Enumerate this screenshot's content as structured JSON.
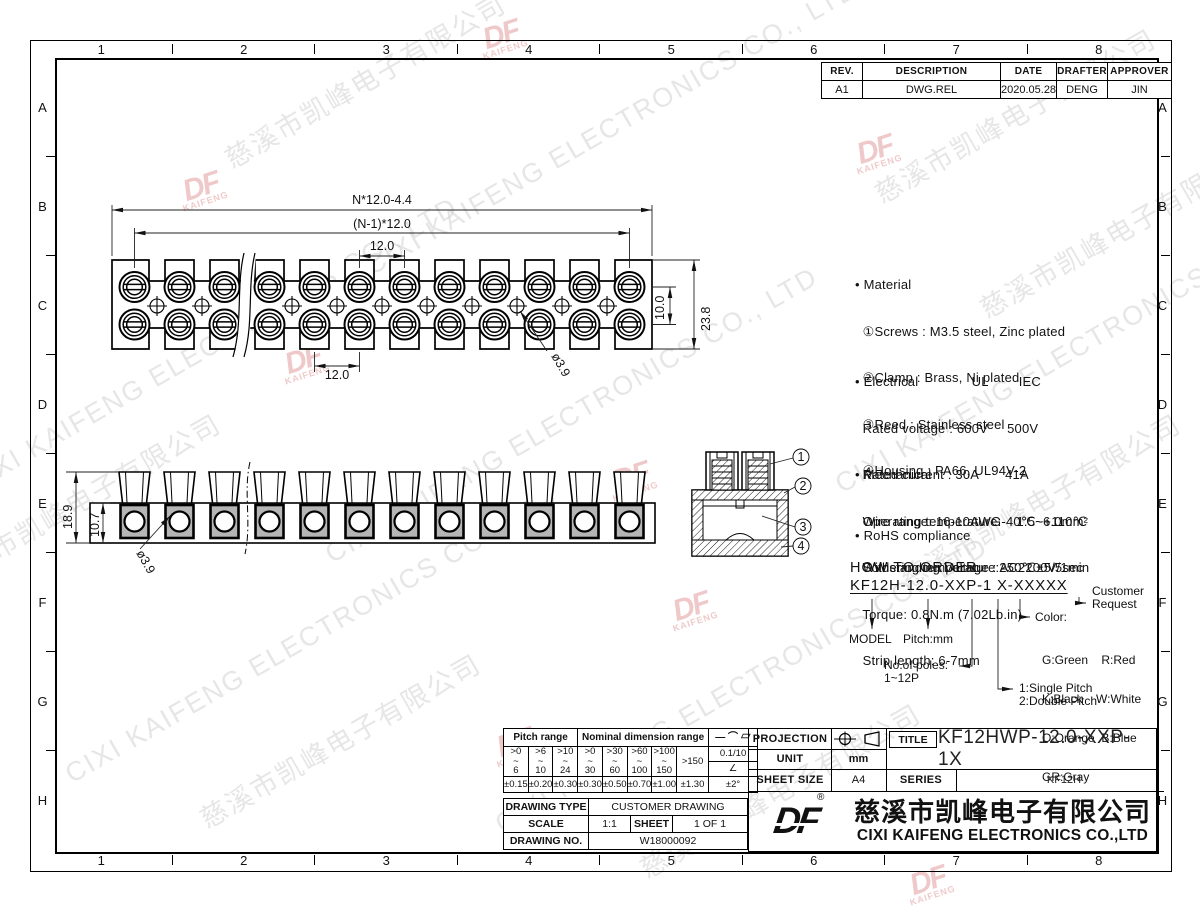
{
  "border": {
    "cols": [
      "1",
      "2",
      "3",
      "4",
      "5",
      "6",
      "7",
      "8"
    ],
    "rows": [
      "A",
      "B",
      "C",
      "D",
      "E",
      "F",
      "G",
      "H"
    ]
  },
  "rev_table": {
    "headers": [
      "REV.",
      "DESCRIPTION",
      "DATE",
      "DRAFTER",
      "APPROVER"
    ],
    "cells": [
      "A1",
      "DWG.REL",
      "2020.05.28",
      "DENG",
      "JIN"
    ]
  },
  "dims": {
    "n_total": "N*12.0-4.4",
    "n_pitch": "(N-1)*12.0",
    "pitch_top": "12.0",
    "pitch_bottom": "12.0",
    "hole_top": "ø3.9",
    "row_gap": "10.0",
    "width_total": "23.8",
    "height_total": "18.9",
    "height_body": "10.7",
    "hole_side": "ø3.9"
  },
  "callouts": [
    "1",
    "2",
    "3",
    "4"
  ],
  "specs": {
    "material": [
      "• Material",
      "  ①Screws : M3.5 steel, Zinc plated",
      "  ②Clamp : Brass, Ni plated",
      "  ③Reed : Stainless steel",
      "  ④Housing : PA66, UL94V-2"
    ],
    "electrical": [
      "• Electrical              UL        IEC",
      "  Rated voltage : 600V     500V",
      "  Rated current : 30A       41A",
      "  Wire range: 16-10AWG    1.5~6.0mm²",
      "  Withstanding Voltage : AC2200V/1min"
    ],
    "mechanical": [
      "• Mechanical",
      "  Operating temperature:-40℃~+110℃",
      "  Soldering temperature:250℃±5/5sec",
      "  Torque: 0.8N.m (7.02Lb.in)",
      "  Strip length: 6-7mm"
    ],
    "rohs": "• RoHS compliance"
  },
  "order": {
    "heading": "HOW TO ORDER",
    "code": "KF12H-12.0-XXP-1 X-XXXXX",
    "model": "MODEL",
    "pitch": "Pitch:mm",
    "poles_1": "No.of poles:",
    "poles_2": "1~12P",
    "color_label": "Color:",
    "colors": [
      "G:Green    R:Red",
      "K:Black    W:White",
      "O:Orange  B:Blue",
      "GR:Gray"
    ],
    "pitch_type_1": "1:Single Pitch",
    "pitch_type_2": "2:Double Pitch",
    "customer_1": "Customer",
    "customer_2": "Request"
  },
  "tol": {
    "pitch_header": "Pitch range",
    "nominal_header": "Nominal dimension range",
    "symbols": "— ⌒ ▱",
    "tilde": "~",
    "ranges": [
      [
        ">0",
        "6"
      ],
      [
        ">6",
        "10"
      ],
      [
        ">10",
        "24"
      ],
      [
        ">0",
        "30"
      ],
      [
        ">30",
        "60"
      ],
      [
        ">60",
        "100"
      ],
      [
        ">100",
        "150"
      ]
    ],
    "last_range": ">150",
    "flat_tol": "0.1/10",
    "angle_symbol": "∠",
    "tols": [
      "±0.15",
      "±0.20",
      "±0.30",
      "±0.30",
      "±0.50",
      "±0.70",
      "±1.00",
      "±1.30"
    ],
    "angle_tol": "±2°"
  },
  "info": {
    "drawing_type_label": "DRAWING TYPE",
    "drawing_type": "CUSTOMER DRAWING",
    "scale_label": "SCALE",
    "scale": "1:1",
    "sheet_label": "SHEET",
    "sheet": "1 OF 1",
    "drawing_no_label": "DRAWING NO.",
    "drawing_no": "W18000092"
  },
  "title_block": {
    "projection_label": "PROJECTION",
    "unit_label": "UNIT",
    "unit": "mm",
    "sheet_size_label": "SHEET SIZE",
    "sheet_size": "A4",
    "title_label": "TITLE",
    "title": "KF12HWP-12.0-XXP-1X",
    "series_label": "SERIES",
    "series": "KF12H"
  },
  "company": {
    "logo": "DF",
    "reg": "®",
    "name_cn": "慈溪市凯峰电子有限公司",
    "name_en": "CIXI KAIFENG ELECTRONICS CO.,LTD"
  },
  "watermark": {
    "cn": "慈溪市凯峰电子有限公司",
    "en": "CIXI KAIFENG ELECTRONICS CO., LTD",
    "logo": "DF",
    "logo_sub": "KAIFENG"
  }
}
